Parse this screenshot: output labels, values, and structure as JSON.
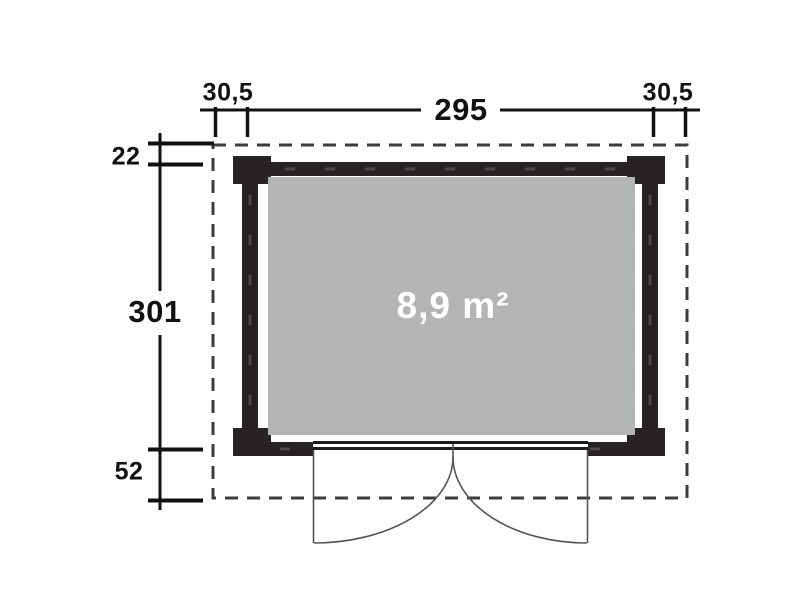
{
  "diagram": {
    "type": "floor-plan",
    "area_label": "8,9 m²",
    "dimensions": {
      "overhang_left": "30,5",
      "outer_width": "295",
      "overhang_right": "30,5",
      "back_offset": "22",
      "outer_depth": "301",
      "front_offset": "52"
    },
    "colors": {
      "wall": "#272223",
      "floor": "#b2b4b6",
      "dimension_text": "#111111",
      "area_text": "#ffffff",
      "dashed_outline": "#3c3c3c",
      "door_line": "#555555",
      "background": "#ffffff"
    }
  }
}
